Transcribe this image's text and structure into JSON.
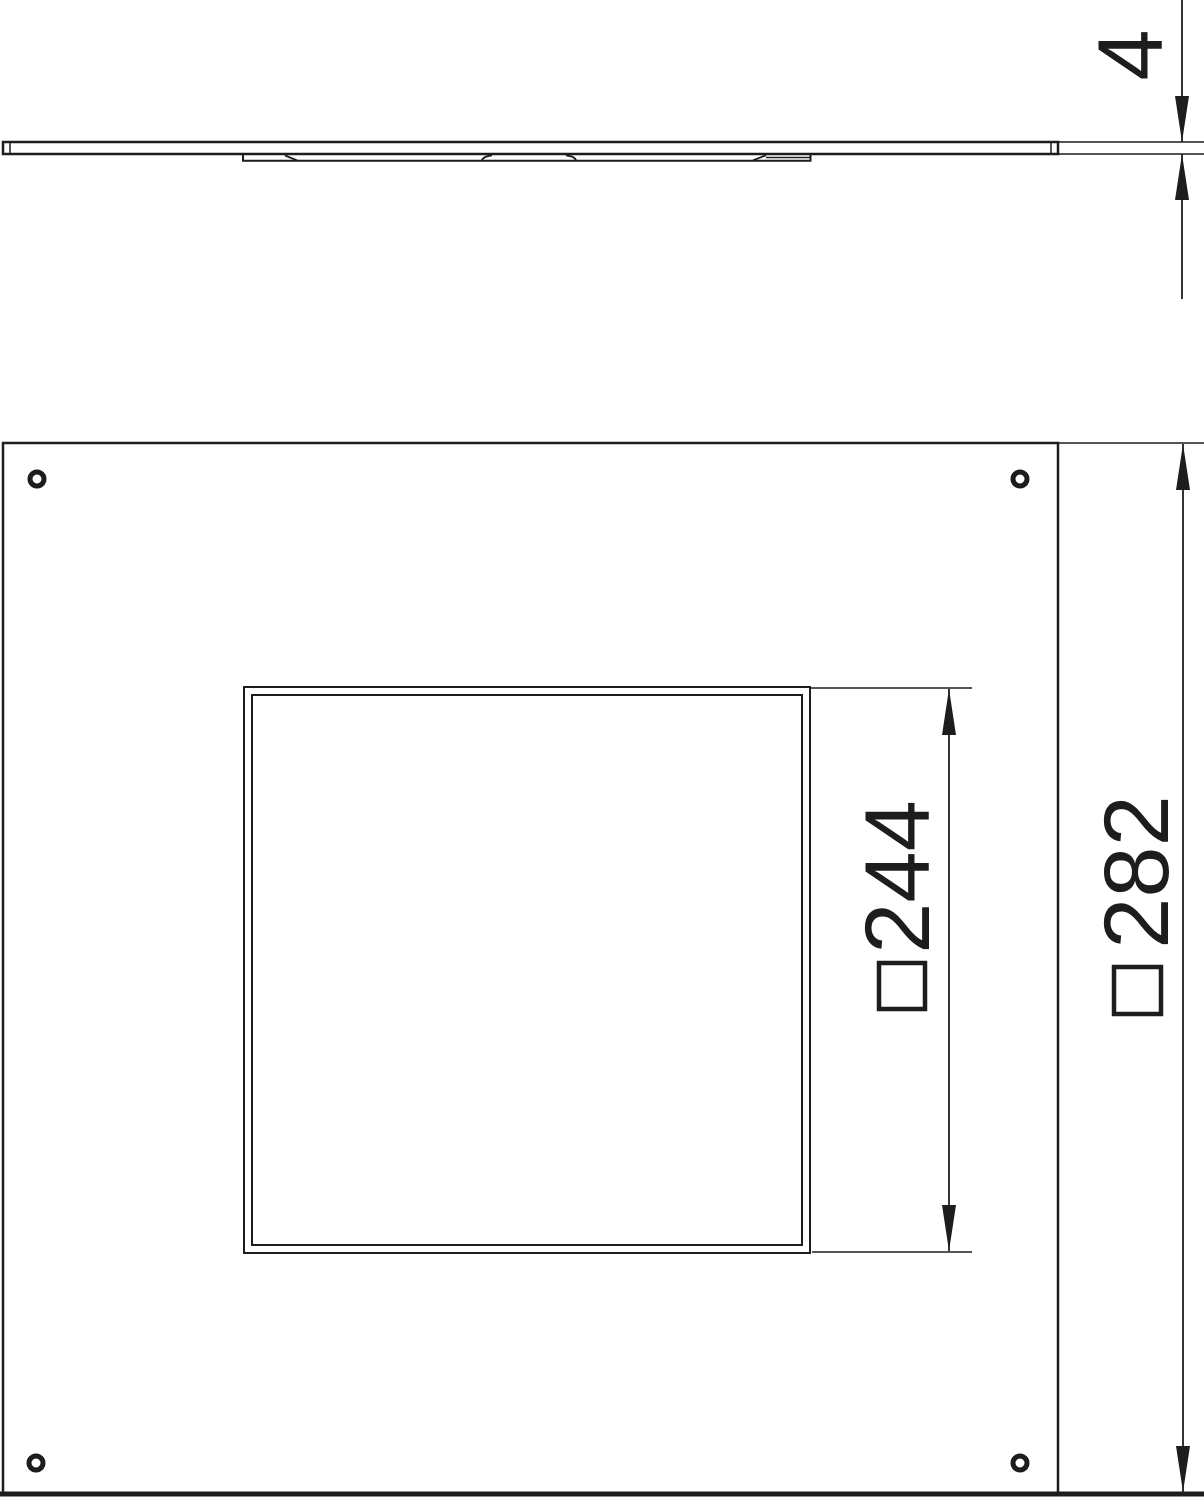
{
  "drawing": {
    "title": "cover-plate-technical-drawing",
    "line_color": "#1d1d1b",
    "background_color": "#ffffff",
    "views": {
      "side_view": {
        "name": "side profile view"
      },
      "plan_view": {
        "name": "underside plan view"
      }
    },
    "dimensions": {
      "thickness": {
        "value": "4",
        "symbol": ""
      },
      "cutout_width": {
        "value": "244",
        "symbol": "□"
      },
      "plate_width": {
        "value": "282",
        "symbol": "□"
      }
    }
  }
}
